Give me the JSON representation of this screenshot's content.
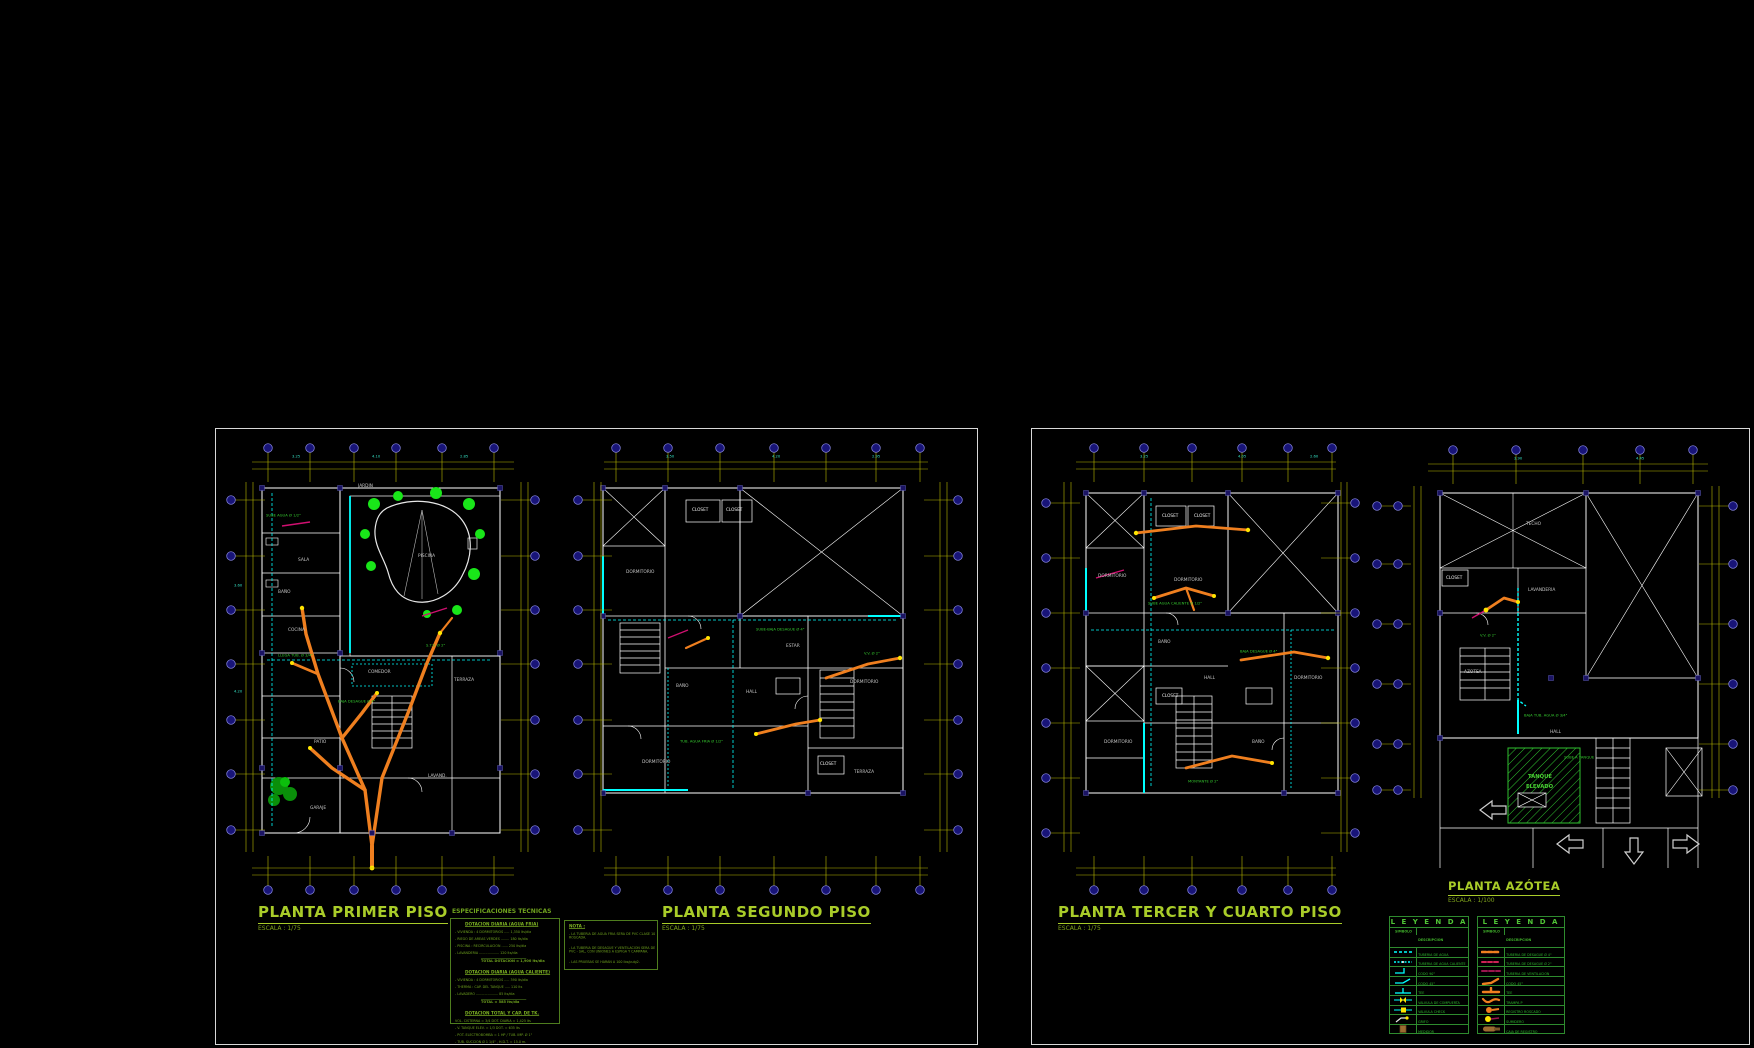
{
  "drawing": {
    "type": "plano sanitario vivienda multifamiliar",
    "background": "#000000",
    "palette": {
      "walls": "#ffffff",
      "grid": "#b9b900",
      "water_pipe": "#00ffff",
      "drain_pipe": "#ef7f1f",
      "drain_2in": "#cc2255",
      "vent": "#99164d",
      "text_green": "#2db82d",
      "title_green": "#a9cc29",
      "bubble": "#181478",
      "tree_green": "#19e619",
      "dim_teal": "#35e2c4"
    }
  },
  "titles": {
    "plan1": {
      "label": "PLANTA PRIMER PISO",
      "scale": "ESCALA : 1/75"
    },
    "plan2": {
      "label": "PLANTA SEGUNDO PISO",
      "scale": "ESCALA : 1/75"
    },
    "plan3": {
      "label": "PLANTA TERCER Y CUARTO PISO",
      "scale": "ESCALA : 1/75"
    },
    "plan4": {
      "label": "PLANTA AZÓTEA",
      "scale": "ESCALA : 1/100"
    }
  },
  "spec": {
    "header": "ESPECIFICACIONES TECNICAS",
    "box1": {
      "sections": [
        {
          "title": "DOTACION DIARIA (AGUA FRIA)",
          "items": [
            "- VIVIENDA : 4 DORMITORIOS ..... 1,350 lts/dia",
            "- RIEGO DE AREAS VERDES ........ 180 lts/dia",
            "- PISCINA : RECIRCULACION ...... 250 lts/dia",
            "- LAVANDERIA ................... 120 lts/dia"
          ],
          "total": "TOTAL DOTACION = 1,900 lts/dia"
        },
        {
          "title": "DOTACION DIARIA (AGUA CALIENTE)",
          "items": [
            "- VIVIENDA : 4 DORMITORIOS ..... 390 lts/dia",
            "- THERMA : CAP. DEL TANQUE ..... 110 lts",
            "- LAVADERO ..................... 85 lts/dia"
          ],
          "total": "TOTAL = 585 lts/dia"
        },
        {
          "title": "DOTACION TOTAL Y CAP. DE TK.",
          "items": [
            "VOL. CISTERNA = 3/4 DOT. DIARIA = 1,425 lts",
            "- V. TANQUE ELEV. = 1/3 DOT. = 635 lts",
            "- POT. ELECTROBOMBA = 1 HP / TUB. IMP. Ø 1\"",
            "- TUB. SUCCION Ø 1 1/4\" , H.D.T. = 15.0 m."
          ],
          "total": ""
        }
      ]
    },
    "nota": {
      "title": "NOTA :",
      "items": [
        "- LA TUBERIA DE AGUA FRIA SERA DE PVC CLASE 10 ROSCADA.",
        "- LA TUBERIA DE DESAGUE Y VENTILACION SERA DE PVC - SAL, CON UNIONES A ESPIGA Y CAMPANA.",
        "- LAS PRUEBAS SE HARAN A 100 lbs/pulg2."
      ]
    }
  },
  "legends": [
    {
      "title": "L E Y E N D A",
      "col_symbol": "SIMBOLO",
      "col_desc": "DESCRIPCION",
      "rows": [
        {
          "glyph": "water-pipe-cold",
          "desc": "TUBERIA DE AGUA"
        },
        {
          "glyph": "water-pipe-hot",
          "desc": "TUBERIA DE AGUA CALIENTE"
        },
        {
          "glyph": "elbow-90",
          "desc": "CODO 90°"
        },
        {
          "glyph": "elbow-45",
          "desc": "CODO 45°"
        },
        {
          "glyph": "tee",
          "desc": "TEE"
        },
        {
          "glyph": "gate-valve",
          "desc": "VALVULA DE COMPUERTA"
        },
        {
          "glyph": "check-valve",
          "desc": "VALVULA CHECK"
        },
        {
          "glyph": "faucet",
          "desc": "GRIFO"
        },
        {
          "glyph": "meter",
          "desc": "MEDIDOR"
        }
      ]
    },
    {
      "title": "L E Y E N D A",
      "col_symbol": "SIMBOLO",
      "col_desc": "DESCRIPCION",
      "rows": [
        {
          "glyph": "drain-pipe-4",
          "desc": "TUBERIA DE DESAGUE Ø 4\""
        },
        {
          "glyph": "drain-pipe-2",
          "desc": "TUBERIA DE DESAGUE Ø 2\""
        },
        {
          "glyph": "vent-pipe",
          "desc": "TUBERIA DE VENTILACION"
        },
        {
          "glyph": "drain-elbow",
          "desc": "CODO 45°"
        },
        {
          "glyph": "drain-tee",
          "desc": "TEE"
        },
        {
          "glyph": "p-trap",
          "desc": "TRAMPA P"
        },
        {
          "glyph": "threaded-register",
          "desc": "REGISTRO ROSCADO"
        },
        {
          "glyph": "floor-drain",
          "desc": "SUMIDERO"
        },
        {
          "glyph": "inspection-box",
          "desc": "CAJA  DE  REGISTRO"
        }
      ]
    }
  ],
  "plans": {
    "plan1": {
      "grid": {
        "h": [
          {
            "y": 24,
            "x0": 30,
            "x1": 292
          },
          {
            "y": 31,
            "x0": 30,
            "x1": 292
          },
          {
            "y": 430,
            "x0": 30,
            "x1": 292
          },
          {
            "y": 437,
            "x0": 30,
            "x1": 292
          }
        ],
        "v": [
          {
            "x": 24,
            "y0": 44,
            "y1": 414
          },
          {
            "x": 31,
            "y0": 44,
            "y1": 414
          },
          {
            "x": 299,
            "y0": 44,
            "y1": 414
          },
          {
            "x": 306,
            "y0": 44,
            "y1": 414
          }
        ],
        "top": {
          "y": 10,
          "xs": [
            46,
            88,
            132,
            174,
            220,
            272
          ]
        },
        "bottom": {
          "y": 452,
          "xs": [
            46,
            88,
            132,
            174,
            220,
            272
          ]
        },
        "left": {
          "x": 9,
          "ys": [
            62,
            118,
            172,
            226,
            282,
            336,
            392
          ]
        },
        "right": {
          "x": 313,
          "ys": [
            62,
            118,
            172,
            226,
            282,
            336,
            392
          ]
        }
      },
      "labels": [
        {
          "t": "JARDIN",
          "x": 136,
          "y": 46,
          "k": "room"
        },
        {
          "t": "PISCINA",
          "x": 196,
          "y": 116,
          "k": "room"
        },
        {
          "t": "SALA",
          "x": 76,
          "y": 120,
          "k": "room"
        },
        {
          "t": "BAÑO",
          "x": 56,
          "y": 152,
          "k": "room"
        },
        {
          "t": "COCINA",
          "x": 66,
          "y": 190,
          "k": "room"
        },
        {
          "t": "COMEDOR",
          "x": 146,
          "y": 232,
          "k": "room"
        },
        {
          "t": "TERRAZA",
          "x": 232,
          "y": 240,
          "k": "room"
        },
        {
          "t": "PATIO",
          "x": 92,
          "y": 302,
          "k": "room"
        },
        {
          "t": "GARAJE",
          "x": 88,
          "y": 368,
          "k": "room"
        },
        {
          "t": "LAVAND.",
          "x": 206,
          "y": 336,
          "k": "room"
        },
        {
          "t": "3.25",
          "x": 70,
          "y": 17,
          "k": "dim"
        },
        {
          "t": "4.10",
          "x": 150,
          "y": 17,
          "k": "dim"
        },
        {
          "t": "2.85",
          "x": 238,
          "y": 17,
          "k": "dim"
        },
        {
          "t": "3.60",
          "x": 12,
          "y": 146,
          "k": "dim"
        },
        {
          "t": "4.20",
          "x": 12,
          "y": 252,
          "k": "dim"
        },
        {
          "t": "SUBE AGUA Ø 1/2\"",
          "x": 44,
          "y": 76,
          "k": "pipe"
        },
        {
          "t": "LLEGA TUB. Ø 3/4\"",
          "x": 56,
          "y": 216,
          "k": "pipe"
        },
        {
          "t": "BAJA DESAGUE Ø 4\"",
          "x": 116,
          "y": 262,
          "k": "pipe"
        },
        {
          "t": "S.T.V. Ø 2\"",
          "x": 204,
          "y": 206,
          "k": "pipe"
        }
      ]
    },
    "plan2": {
      "grid": {
        "h": [
          {
            "y": 24,
            "x0": 36,
            "x1": 360
          },
          {
            "y": 31,
            "x0": 36,
            "x1": 360
          },
          {
            "y": 430,
            "x0": 36,
            "x1": 360
          },
          {
            "y": 437,
            "x0": 36,
            "x1": 360
          }
        ],
        "v": [
          {
            "x": 26,
            "y0": 44,
            "y1": 414
          },
          {
            "x": 33,
            "y0": 44,
            "y1": 414
          },
          {
            "x": 372,
            "y0": 44,
            "y1": 414
          },
          {
            "x": 379,
            "y0": 44,
            "y1": 414
          }
        ],
        "top": {
          "y": 10,
          "xs": [
            48,
            100,
            152,
            206,
            258,
            308,
            352
          ]
        },
        "bottom": {
          "y": 452,
          "xs": [
            48,
            100,
            152,
            206,
            258,
            308,
            352
          ]
        },
        "left": {
          "x": 10,
          "ys": [
            62,
            118,
            172,
            226,
            282,
            336,
            392
          ]
        },
        "right": {
          "x": 390,
          "ys": [
            62,
            118,
            172,
            226,
            282,
            336,
            392
          ]
        }
      },
      "labels": [
        {
          "t": "DORMITORIO",
          "x": 58,
          "y": 132,
          "k": "room"
        },
        {
          "t": "CLOSET",
          "x": 124,
          "y": 70,
          "k": "white"
        },
        {
          "t": "CLOSET",
          "x": 158,
          "y": 70,
          "k": "white"
        },
        {
          "t": "ESTAR",
          "x": 218,
          "y": 206,
          "k": "room"
        },
        {
          "t": "DORMITORIO",
          "x": 282,
          "y": 242,
          "k": "room"
        },
        {
          "t": "BAÑO",
          "x": 108,
          "y": 246,
          "k": "room"
        },
        {
          "t": "HALL",
          "x": 178,
          "y": 252,
          "k": "room"
        },
        {
          "t": "DORMITORIO",
          "x": 74,
          "y": 322,
          "k": "room"
        },
        {
          "t": "TERRAZA",
          "x": 286,
          "y": 332,
          "k": "room"
        },
        {
          "t": "CLOSET",
          "x": 252,
          "y": 324,
          "k": "white"
        },
        {
          "t": "3.50",
          "x": 98,
          "y": 17,
          "k": "dim"
        },
        {
          "t": "4.20",
          "x": 204,
          "y": 17,
          "k": "dim"
        },
        {
          "t": "2.95",
          "x": 304,
          "y": 17,
          "k": "dim"
        },
        {
          "t": "SUBE-BAJA DESAGUE Ø 4\"",
          "x": 188,
          "y": 190,
          "k": "pipe"
        },
        {
          "t": "TUB. AGUA FRIA Ø 1/2\"",
          "x": 112,
          "y": 302,
          "k": "pipe"
        },
        {
          "t": "V.V. Ø 2\"",
          "x": 296,
          "y": 214,
          "k": "pipe"
        }
      ]
    },
    "plan3": {
      "grid": {
        "h": [
          {
            "y": 24,
            "x0": 40,
            "x1": 300
          },
          {
            "y": 31,
            "x0": 40,
            "x1": 300
          },
          {
            "y": 430,
            "x0": 40,
            "x1": 300
          },
          {
            "y": 437,
            "x0": 40,
            "x1": 300
          }
        ],
        "v": [
          {
            "x": 28,
            "y0": 44,
            "y1": 414
          },
          {
            "x": 35,
            "y0": 44,
            "y1": 414
          },
          {
            "x": 305,
            "y0": 44,
            "y1": 414
          },
          {
            "x": 311,
            "y0": 44,
            "y1": 414
          }
        ],
        "top": {
          "y": 10,
          "xs": [
            58,
            108,
            156,
            206,
            252,
            296
          ]
        },
        "bottom": {
          "y": 452,
          "xs": [
            58,
            108,
            156,
            206,
            252,
            296
          ]
        },
        "left": {
          "x": 10,
          "ys": [
            65,
            120,
            175,
            230,
            285,
            340,
            395
          ]
        },
        "right": {
          "x": 319,
          "ys": [
            65,
            120,
            175,
            230,
            285,
            340,
            395
          ]
        }
      },
      "labels": [
        {
          "t": "DORMITORIO",
          "x": 62,
          "y": 136,
          "k": "room"
        },
        {
          "t": "CLOSET",
          "x": 126,
          "y": 76,
          "k": "white"
        },
        {
          "t": "CLOSET",
          "x": 158,
          "y": 76,
          "k": "white"
        },
        {
          "t": "DORMITORIO",
          "x": 138,
          "y": 140,
          "k": "room"
        },
        {
          "t": "BAÑO",
          "x": 122,
          "y": 202,
          "k": "room"
        },
        {
          "t": "HALL",
          "x": 168,
          "y": 238,
          "k": "room"
        },
        {
          "t": "DORMITORIO",
          "x": 258,
          "y": 238,
          "k": "room"
        },
        {
          "t": "CLOSET",
          "x": 126,
          "y": 256,
          "k": "white"
        },
        {
          "t": "DORMITORIO",
          "x": 68,
          "y": 302,
          "k": "room"
        },
        {
          "t": "BAÑO",
          "x": 216,
          "y": 302,
          "k": "room"
        },
        {
          "t": "3.25",
          "x": 104,
          "y": 17,
          "k": "dim"
        },
        {
          "t": "4.05",
          "x": 202,
          "y": 17,
          "k": "dim"
        },
        {
          "t": "2.60",
          "x": 274,
          "y": 17,
          "k": "dim"
        },
        {
          "t": "SUBE AGUA CALIENTE Ø 1/2\"",
          "x": 112,
          "y": 164,
          "k": "pipe"
        },
        {
          "t": "BAJA DESAGUE Ø 4\"",
          "x": 204,
          "y": 212,
          "k": "pipe"
        },
        {
          "t": "MONTANTE Ø 2\"",
          "x": 152,
          "y": 342,
          "k": "pipe"
        }
      ]
    },
    "plan4": {
      "grid": {
        "h": [
          {
            "y": 26,
            "x0": 60,
            "x1": 340
          },
          {
            "y": 33,
            "x0": 60,
            "x1": 340
          }
        ],
        "v": [
          {
            "x": 46,
            "y0": 48,
            "y1": 360
          },
          {
            "x": 53,
            "y0": 48,
            "y1": 360
          },
          {
            "x": 344,
            "y0": 48,
            "y1": 360
          },
          {
            "x": 351,
            "y0": 48,
            "y1": 360
          }
        ],
        "top": {
          "y": 12,
          "xs": [
            85,
            148,
            215,
            272,
            325
          ]
        },
        "left": {
          "x": 9,
          "ys": [
            68,
            126,
            186,
            246,
            306,
            352
          ]
        },
        "left2": {
          "x": 30,
          "ys": [
            68,
            126,
            186,
            246,
            306,
            352
          ]
        },
        "right": {
          "x": 365,
          "ys": [
            68,
            126,
            186,
            246,
            306,
            352
          ]
        }
      },
      "labels": [
        {
          "t": "TECHO",
          "x": 158,
          "y": 84,
          "k": "room"
        },
        {
          "t": "CLOSET",
          "x": 78,
          "y": 138,
          "k": "white"
        },
        {
          "t": "LAVANDERIA",
          "x": 160,
          "y": 150,
          "k": "room"
        },
        {
          "t": "AZOTEA",
          "x": 96,
          "y": 232,
          "k": "room"
        },
        {
          "t": "TANQUE",
          "x": 160,
          "y": 336,
          "k": "tank"
        },
        {
          "t": "ELEVADO",
          "x": 158,
          "y": 346,
          "k": "tank"
        },
        {
          "t": "HALL",
          "x": 182,
          "y": 292,
          "k": "room"
        },
        {
          "t": "3.90",
          "x": 146,
          "y": 19,
          "k": "dim"
        },
        {
          "t": "4.45",
          "x": 268,
          "y": 19,
          "k": "dim"
        },
        {
          "t": "BAJA TUB. AGUA Ø 3/4\"",
          "x": 156,
          "y": 276,
          "k": "pipe"
        },
        {
          "t": "V.V. Ø 2\"",
          "x": 112,
          "y": 196,
          "k": "pipe"
        },
        {
          "t": "SUBE A TANQUE",
          "x": 196,
          "y": 318,
          "k": "pipe"
        }
      ]
    }
  }
}
